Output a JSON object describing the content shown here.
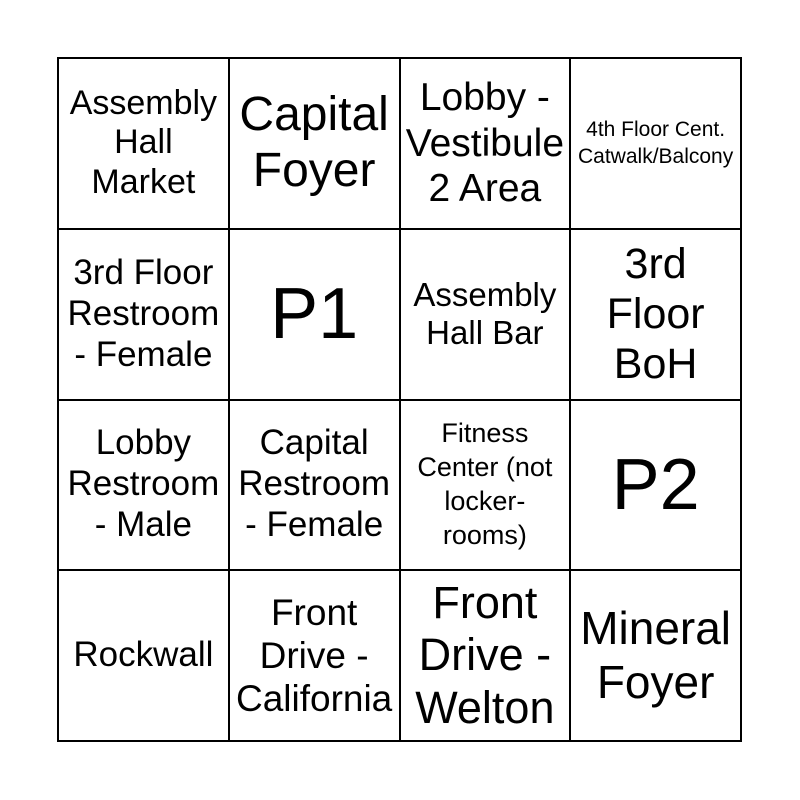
{
  "colors": {
    "background": "#ffffff",
    "grid_line": "#000000",
    "text": "#000000"
  },
  "grid": {
    "rows": 4,
    "cols": 4,
    "cells": [
      {
        "text": "Assembly\nHall\nMarket"
      },
      {
        "text": "Capital\nFoyer"
      },
      {
        "text": "Lobby -\nVestibule\n2 Area"
      },
      {
        "text": "4th Floor Cent.\nCatwalk/Balcony"
      },
      {
        "text": "3rd Floor\nRestroom\n- Female"
      },
      {
        "text": "P1"
      },
      {
        "text": "Assembly\nHall Bar"
      },
      {
        "text": "3rd\nFloor\nBoH"
      },
      {
        "text": "Lobby\nRestroom\n- Male"
      },
      {
        "text": "Capital\nRestroom\n- Female"
      },
      {
        "text": "Fitness\nCenter (not\nlocker-\nrooms)"
      },
      {
        "text": "P2"
      },
      {
        "text": "Rockwall"
      },
      {
        "text": "Front\nDrive -\nCalifornia"
      },
      {
        "text": "Front\nDrive -\nWelton"
      },
      {
        "text": "Mineral\nFoyer"
      }
    ]
  }
}
